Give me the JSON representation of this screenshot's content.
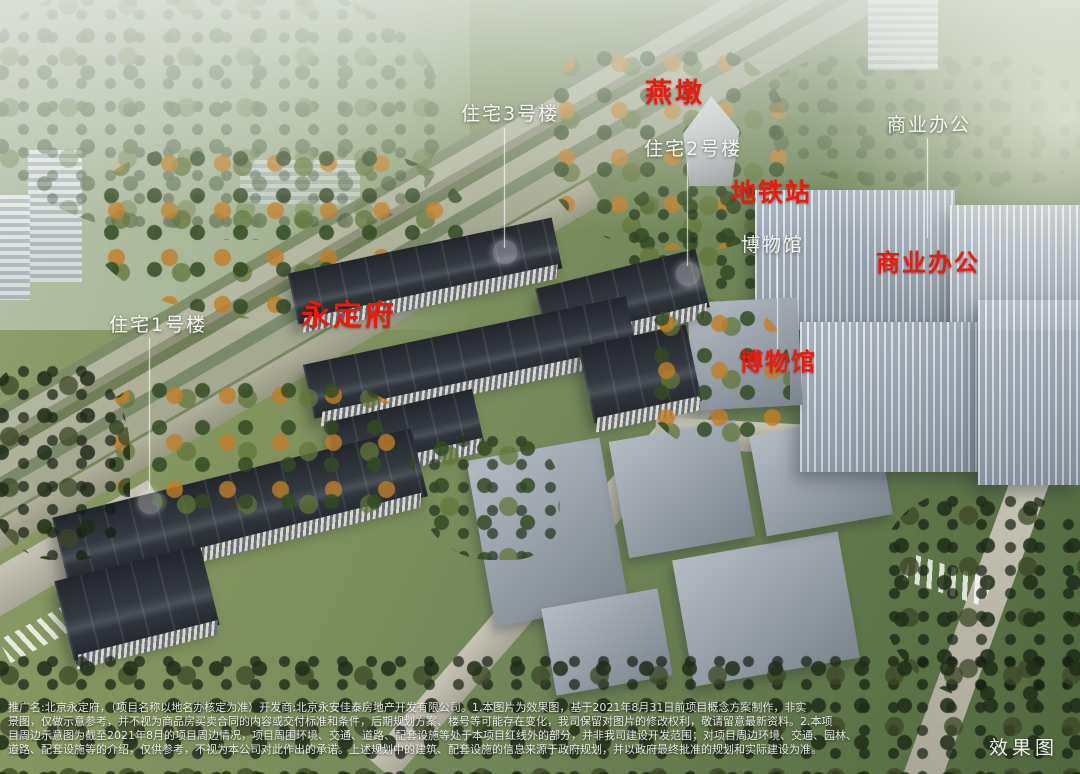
{
  "colors": {
    "red_label": "#e81c0e",
    "white_label": "#f7f6f2",
    "residential_roof": "#2e3339",
    "commercial_facade": "#a8b2be",
    "vegetation_green": "#5e7549",
    "autumn_orange": "#c07e28"
  },
  "labels": [
    {
      "id": "yandun",
      "text": "燕墩",
      "style": "red"
    },
    {
      "id": "residential-3",
      "text": "住宅3号楼",
      "style": "white"
    },
    {
      "id": "residential-2",
      "text": "住宅2号楼",
      "style": "white"
    },
    {
      "id": "commercial-office-far",
      "text": "商业办公",
      "style": "white"
    },
    {
      "id": "metro-station",
      "text": "地铁站",
      "style": "red"
    },
    {
      "id": "museum-far",
      "text": "博物馆",
      "style": "white"
    },
    {
      "id": "commercial-office",
      "text": "商业办公",
      "style": "red"
    },
    {
      "id": "yongdingfu",
      "text": "永定府",
      "style": "red"
    },
    {
      "id": "museum",
      "text": "博物馆",
      "style": "red"
    },
    {
      "id": "residential-1",
      "text": "住宅1号楼",
      "style": "white"
    }
  ],
  "watermark": {
    "text": "效果图"
  },
  "disclaimer": [
    "推广名:北京永定府，（项目名称以地名办核定为准）开发商:北京永安佳泰房地产开发有限公司。1.本图片为效果图，基于2021年8月31日前项目概念方案制作，非实",
    "景图，仅做示意参考，并不视为商品房买卖合同的内容或交付标准和条件，后期规划方案、楼号等可能存在变化，我司保留对图片的修改权利，敬请留意最新资料。2.本项",
    "目周边示意图为截至2021年8月的项目周边情况，项目周围环境、交通、道路、配套设施等处于本项目红线外的部分，并非我司建设开发范围；对项目周边环境、交通、园林、",
    "道路、配套设施等的介绍，仅供参考，不视为本公司对此作出的承诺。上述规划中的建筑、配套设施的信息来源于政府规划，并以政府最终批准的规划和实际建设为准。"
  ]
}
